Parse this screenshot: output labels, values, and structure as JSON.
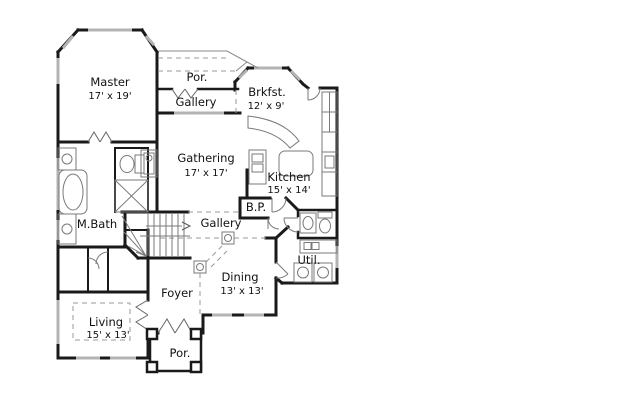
{
  "rooms": {
    "master": {
      "name": "Master",
      "dims": "17' x 19'"
    },
    "porch_top": {
      "name": "Por."
    },
    "gallery_top": {
      "name": "Gallery"
    },
    "breakfast": {
      "name": "Brkfst.",
      "dims": "12' x 9'"
    },
    "gathering": {
      "name": "Gathering",
      "dims": "17' x 17'"
    },
    "kitchen": {
      "name": "Kitchen",
      "dims": "15' x 14'"
    },
    "butlers_pantry": {
      "name": "B.P."
    },
    "master_bath": {
      "name": "M.Bath"
    },
    "gallery_mid": {
      "name": "Gallery"
    },
    "utility": {
      "name": "Util."
    },
    "dining": {
      "name": "Dining",
      "dims": "13' x 13'"
    },
    "foyer": {
      "name": "Foyer"
    },
    "living": {
      "name": "Living",
      "dims": "15' x 13'"
    },
    "porch_bottom": {
      "name": "Por."
    }
  },
  "colors": {
    "wall": "#1a1a1a",
    "window": "#b3b3b3",
    "fixture": "#7a7a7a",
    "dashed": "#9a9a9a",
    "background": "#ffffff",
    "text": "#111111"
  }
}
